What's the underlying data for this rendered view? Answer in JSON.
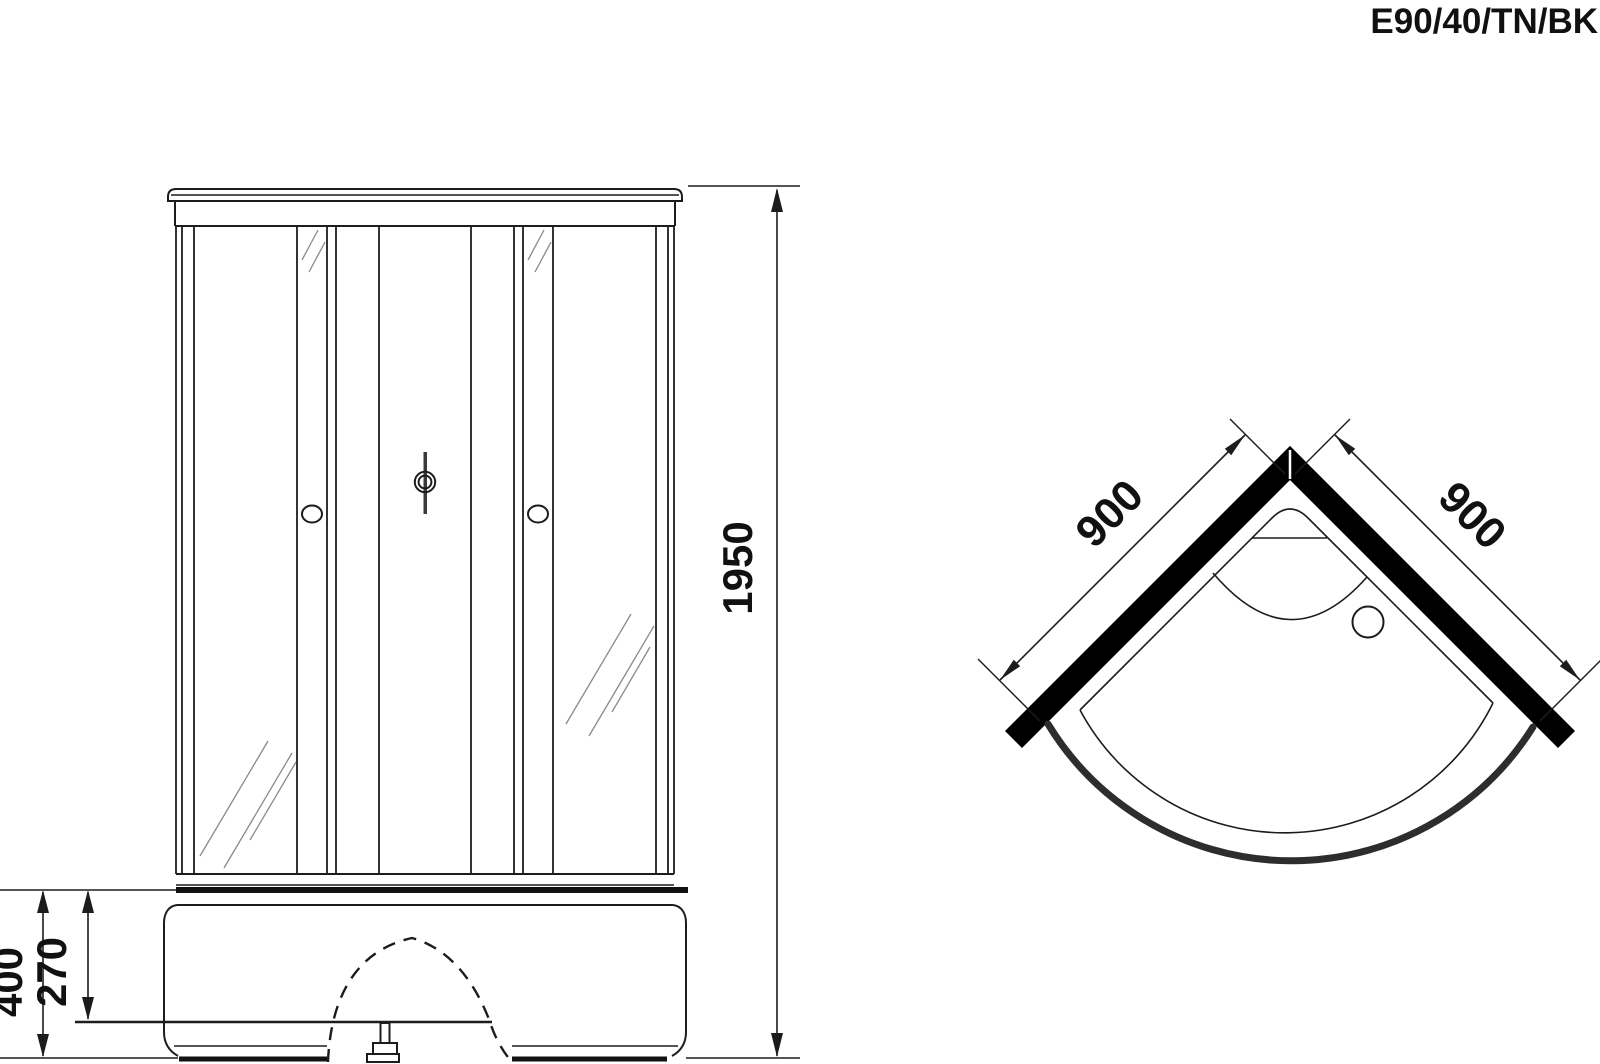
{
  "title": "E90/40/TN/BK",
  "front_view": {
    "label": "front-elevation",
    "dimensions": {
      "overall_height": "1950",
      "base_height": "400",
      "tray_depth": "270"
    }
  },
  "top_view": {
    "label": "plan-view",
    "dimensions": {
      "left_side_width": "900",
      "right_side_width": "900"
    }
  },
  "colors": {
    "line": "#1c1c1c",
    "wall": "#000000",
    "rim": "#2d2d2d",
    "background": "#ffffff",
    "reflection": "#8a8a8a"
  }
}
